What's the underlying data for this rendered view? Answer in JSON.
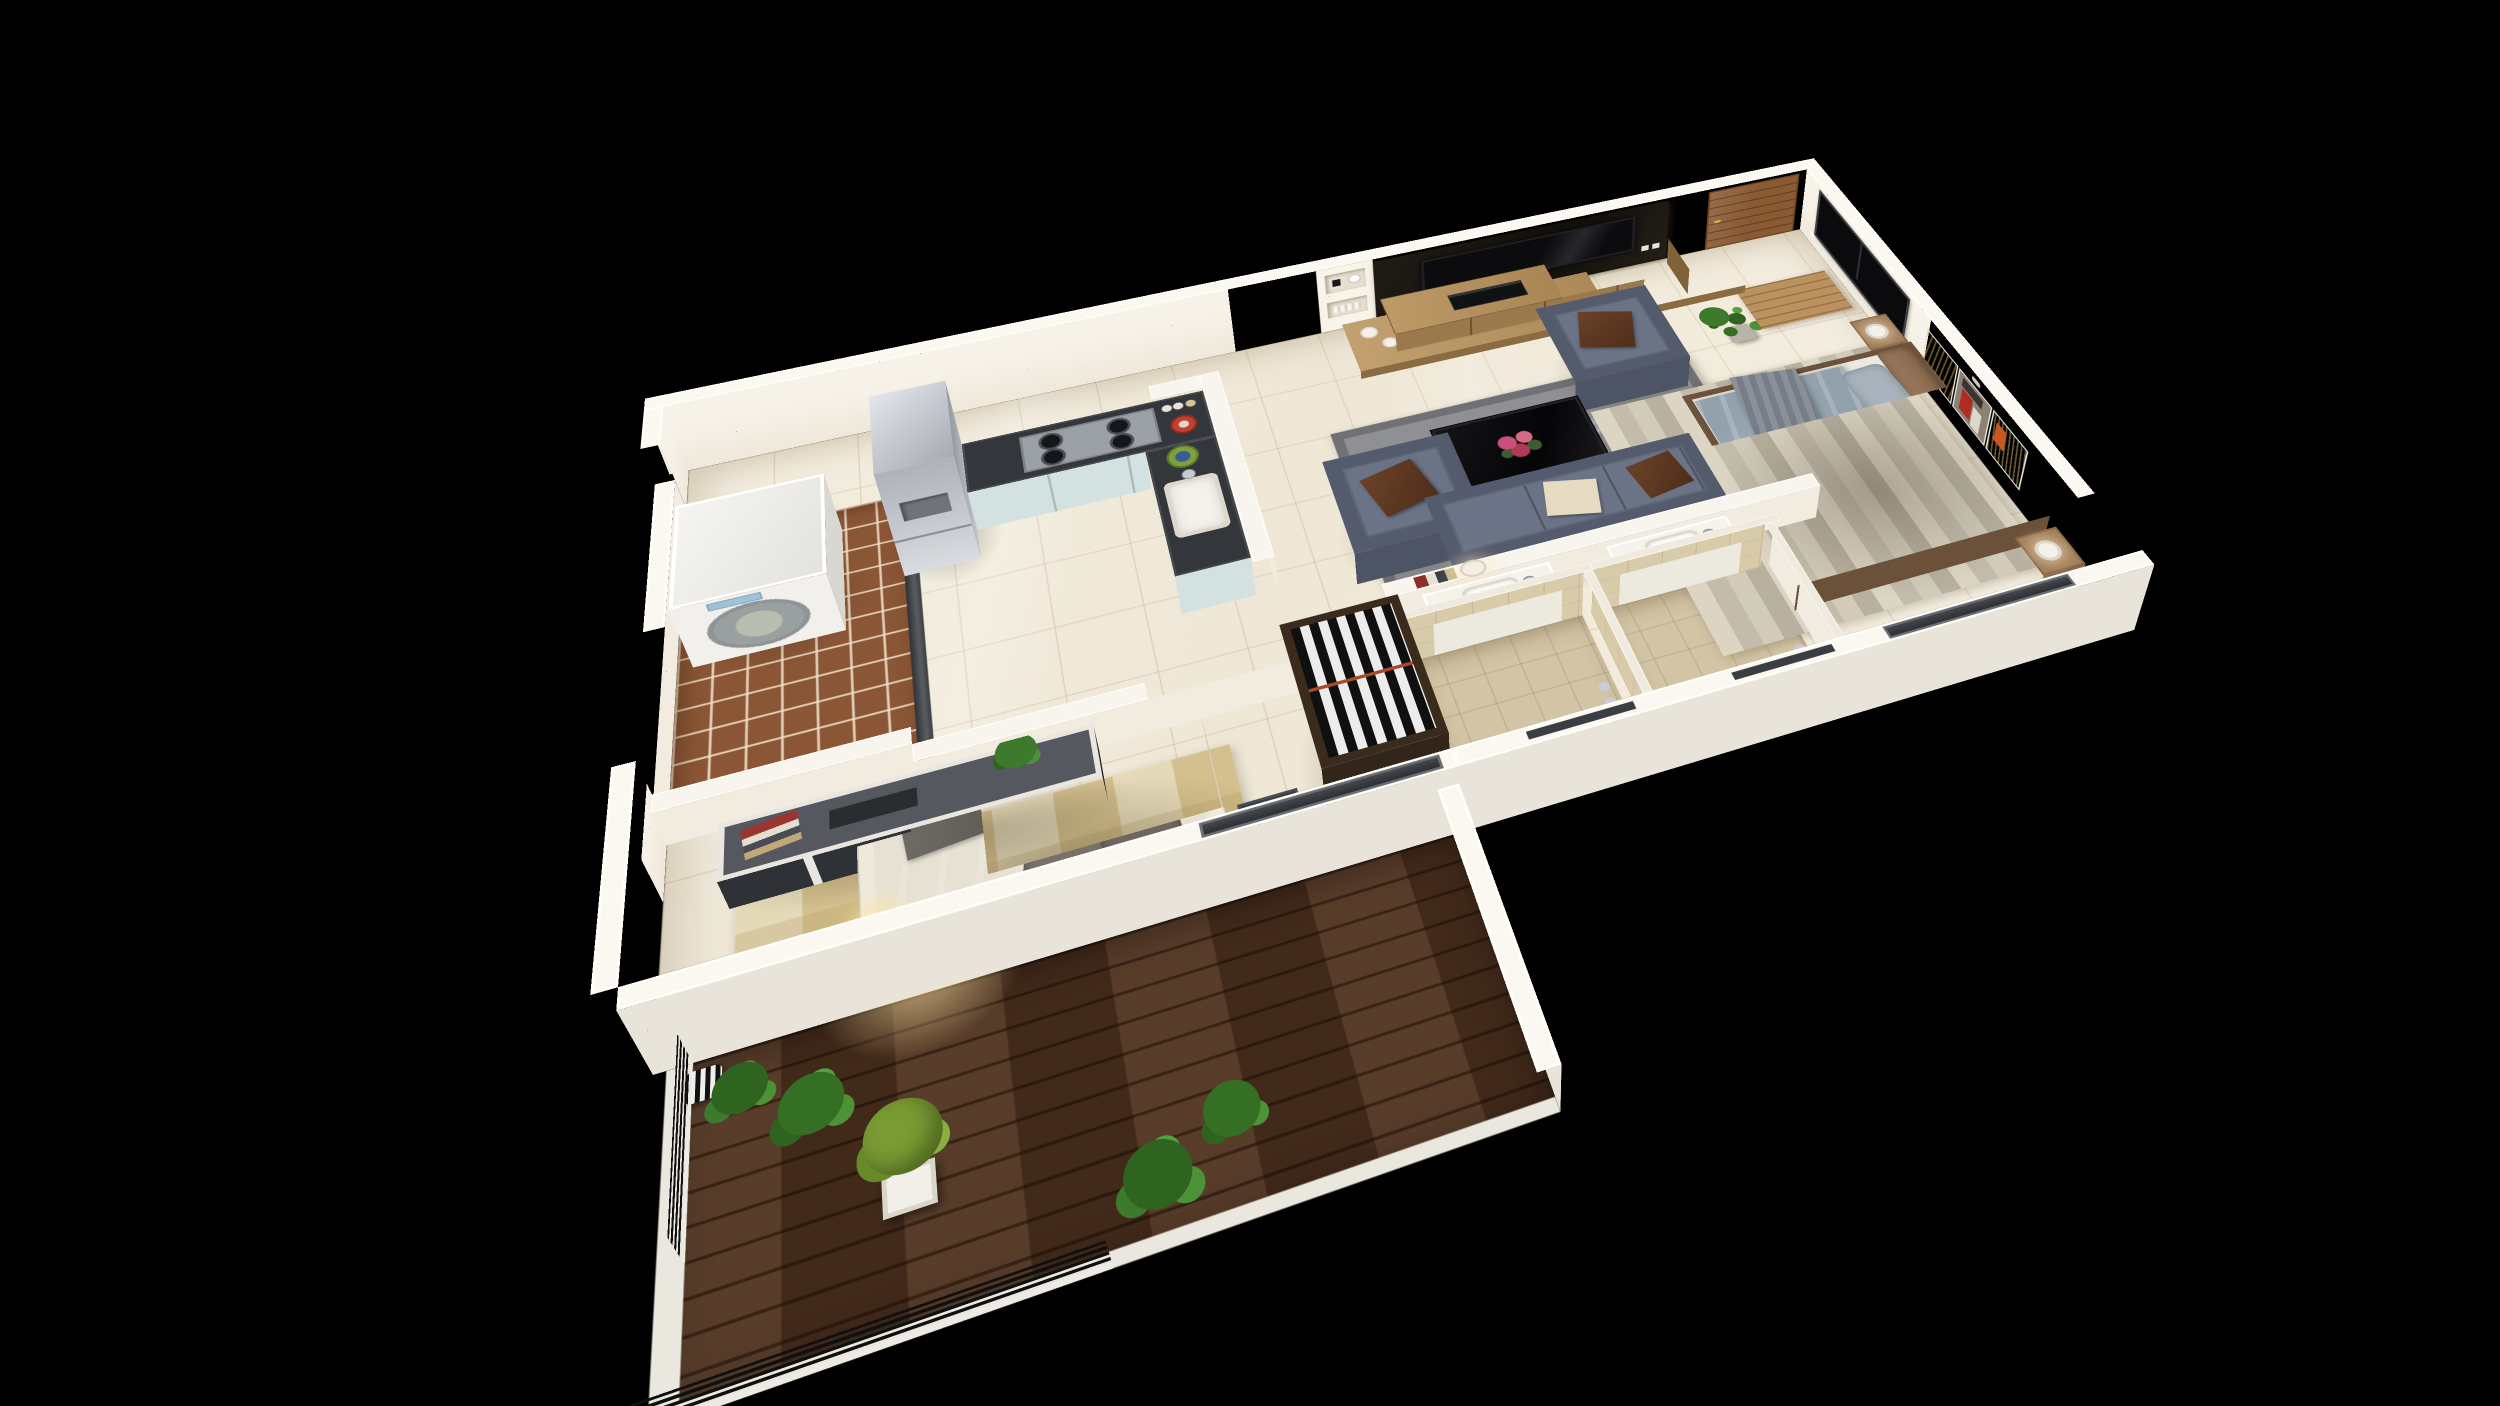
{
  "scene": {
    "type": "3d-isometric-floor-plan-render",
    "description": "Photorealistic dollhouse cutaway render of a one/two-bedroom apartment on a black background",
    "background_color": "#000000",
    "wall_color": "#f3ede1",
    "floor_tile_color": "#f0e9da"
  },
  "rooms": {
    "living": {
      "name": "Living Room"
    },
    "kitchen": {
      "name": "Open Kitchen"
    },
    "utility": {
      "name": "Utility / Dry Balcony"
    },
    "foyer": {
      "name": "Entrance Foyer"
    },
    "bedroom1": {
      "name": "Master Bedroom"
    },
    "bedroom2": {
      "name": "Second Bedroom"
    },
    "bath1": {
      "name": "Bathroom 1"
    },
    "bath2": {
      "name": "Bathroom 2"
    },
    "balcony": {
      "name": "Wood Deck Balcony"
    }
  },
  "furniture": {
    "living": [
      "tv-feature-panel",
      "flat-screen-tv",
      "wall-shelf-niches",
      "wood-tv-console",
      "media-player",
      "sofa-3-seat",
      "armchair-x2",
      "black-glass-coffee-table",
      "flower-centerpiece",
      "gray-shag-rug",
      "table-lamp-on-half-wall",
      "magazines",
      "potted-plant",
      "white-vases"
    ],
    "kitchen": [
      "stainless-fridge",
      "l-shaped-counter",
      "gas-hob-4-burner",
      "sink-basin",
      "mixing-bowls",
      "spice-jars",
      "knee-wall"
    ],
    "utility": [
      "front-load-washing-machine",
      "terracotta-floor-tiles",
      "threshold-track"
    ],
    "foyer": [
      "wood-entrance-door",
      "wood-door-mat"
    ],
    "bedroom1": [
      "platform-double-bed",
      "gray-blue-duvet",
      "throw-blanket",
      "nightstand-x2",
      "white-table-lamp-x2",
      "striped-area-rug",
      "abstract-triptych-painting",
      "black-window",
      "sliding-glass-window"
    ],
    "bedroom2": [
      "double-bed-cream-frame",
      "taupe-duvet",
      "dark-pillows",
      "media-cabinet",
      "cabinet-plant",
      "checkered-beige-rug",
      "floor-lamp-lit",
      "side-table-with-cup",
      "wardrobe-open-striped-clothes",
      "sliding-door-to-balcony"
    ],
    "bath1": [
      "white-vanity-basin",
      "chrome-faucet",
      "shower-tray",
      "tan-tiled-walls",
      "door-track"
    ],
    "bath2": [
      "white-vanity-basin",
      "chrome-faucet",
      "shower-tray",
      "tan-tiled-walls",
      "door-track"
    ],
    "balcony": [
      "walnut-plank-deck",
      "black-bar-railing",
      "potted-palm-x4",
      "yellow-green-shrub",
      "white-square-planter",
      "striped-decor-pot"
    ]
  },
  "palette": {
    "background": "#000000",
    "wall_top": "#fbf8f1",
    "wall_inner": "#f3ede1",
    "wall_outer": "#e8e4da",
    "floor_tile": "#f0e9da",
    "utility_tile": "#8a5636",
    "bath_tile": "#d2c4a4",
    "deck_wood": "#4e3220",
    "tv_panel": "#17130e",
    "door_wood": "#8a5a33",
    "sofa_slate": "#5f6678",
    "pillow_brown": "#5c3a26",
    "rug_gray": "#8f9094",
    "bed1_duvet": "#93a1ad",
    "bed2_duvet": "#9c8e80",
    "rug2_beige": "#e5dab8",
    "counter_top": "#33363a",
    "cabinet_mint": "#d3e2e0",
    "fridge_steel": "#c6cacf",
    "painting_orange": "#c97a2b",
    "painting_red": "#b02c20",
    "plant_green": "#3e7a2b",
    "railing_black": "#101010",
    "lamp_glow": "#ffe0a0"
  }
}
